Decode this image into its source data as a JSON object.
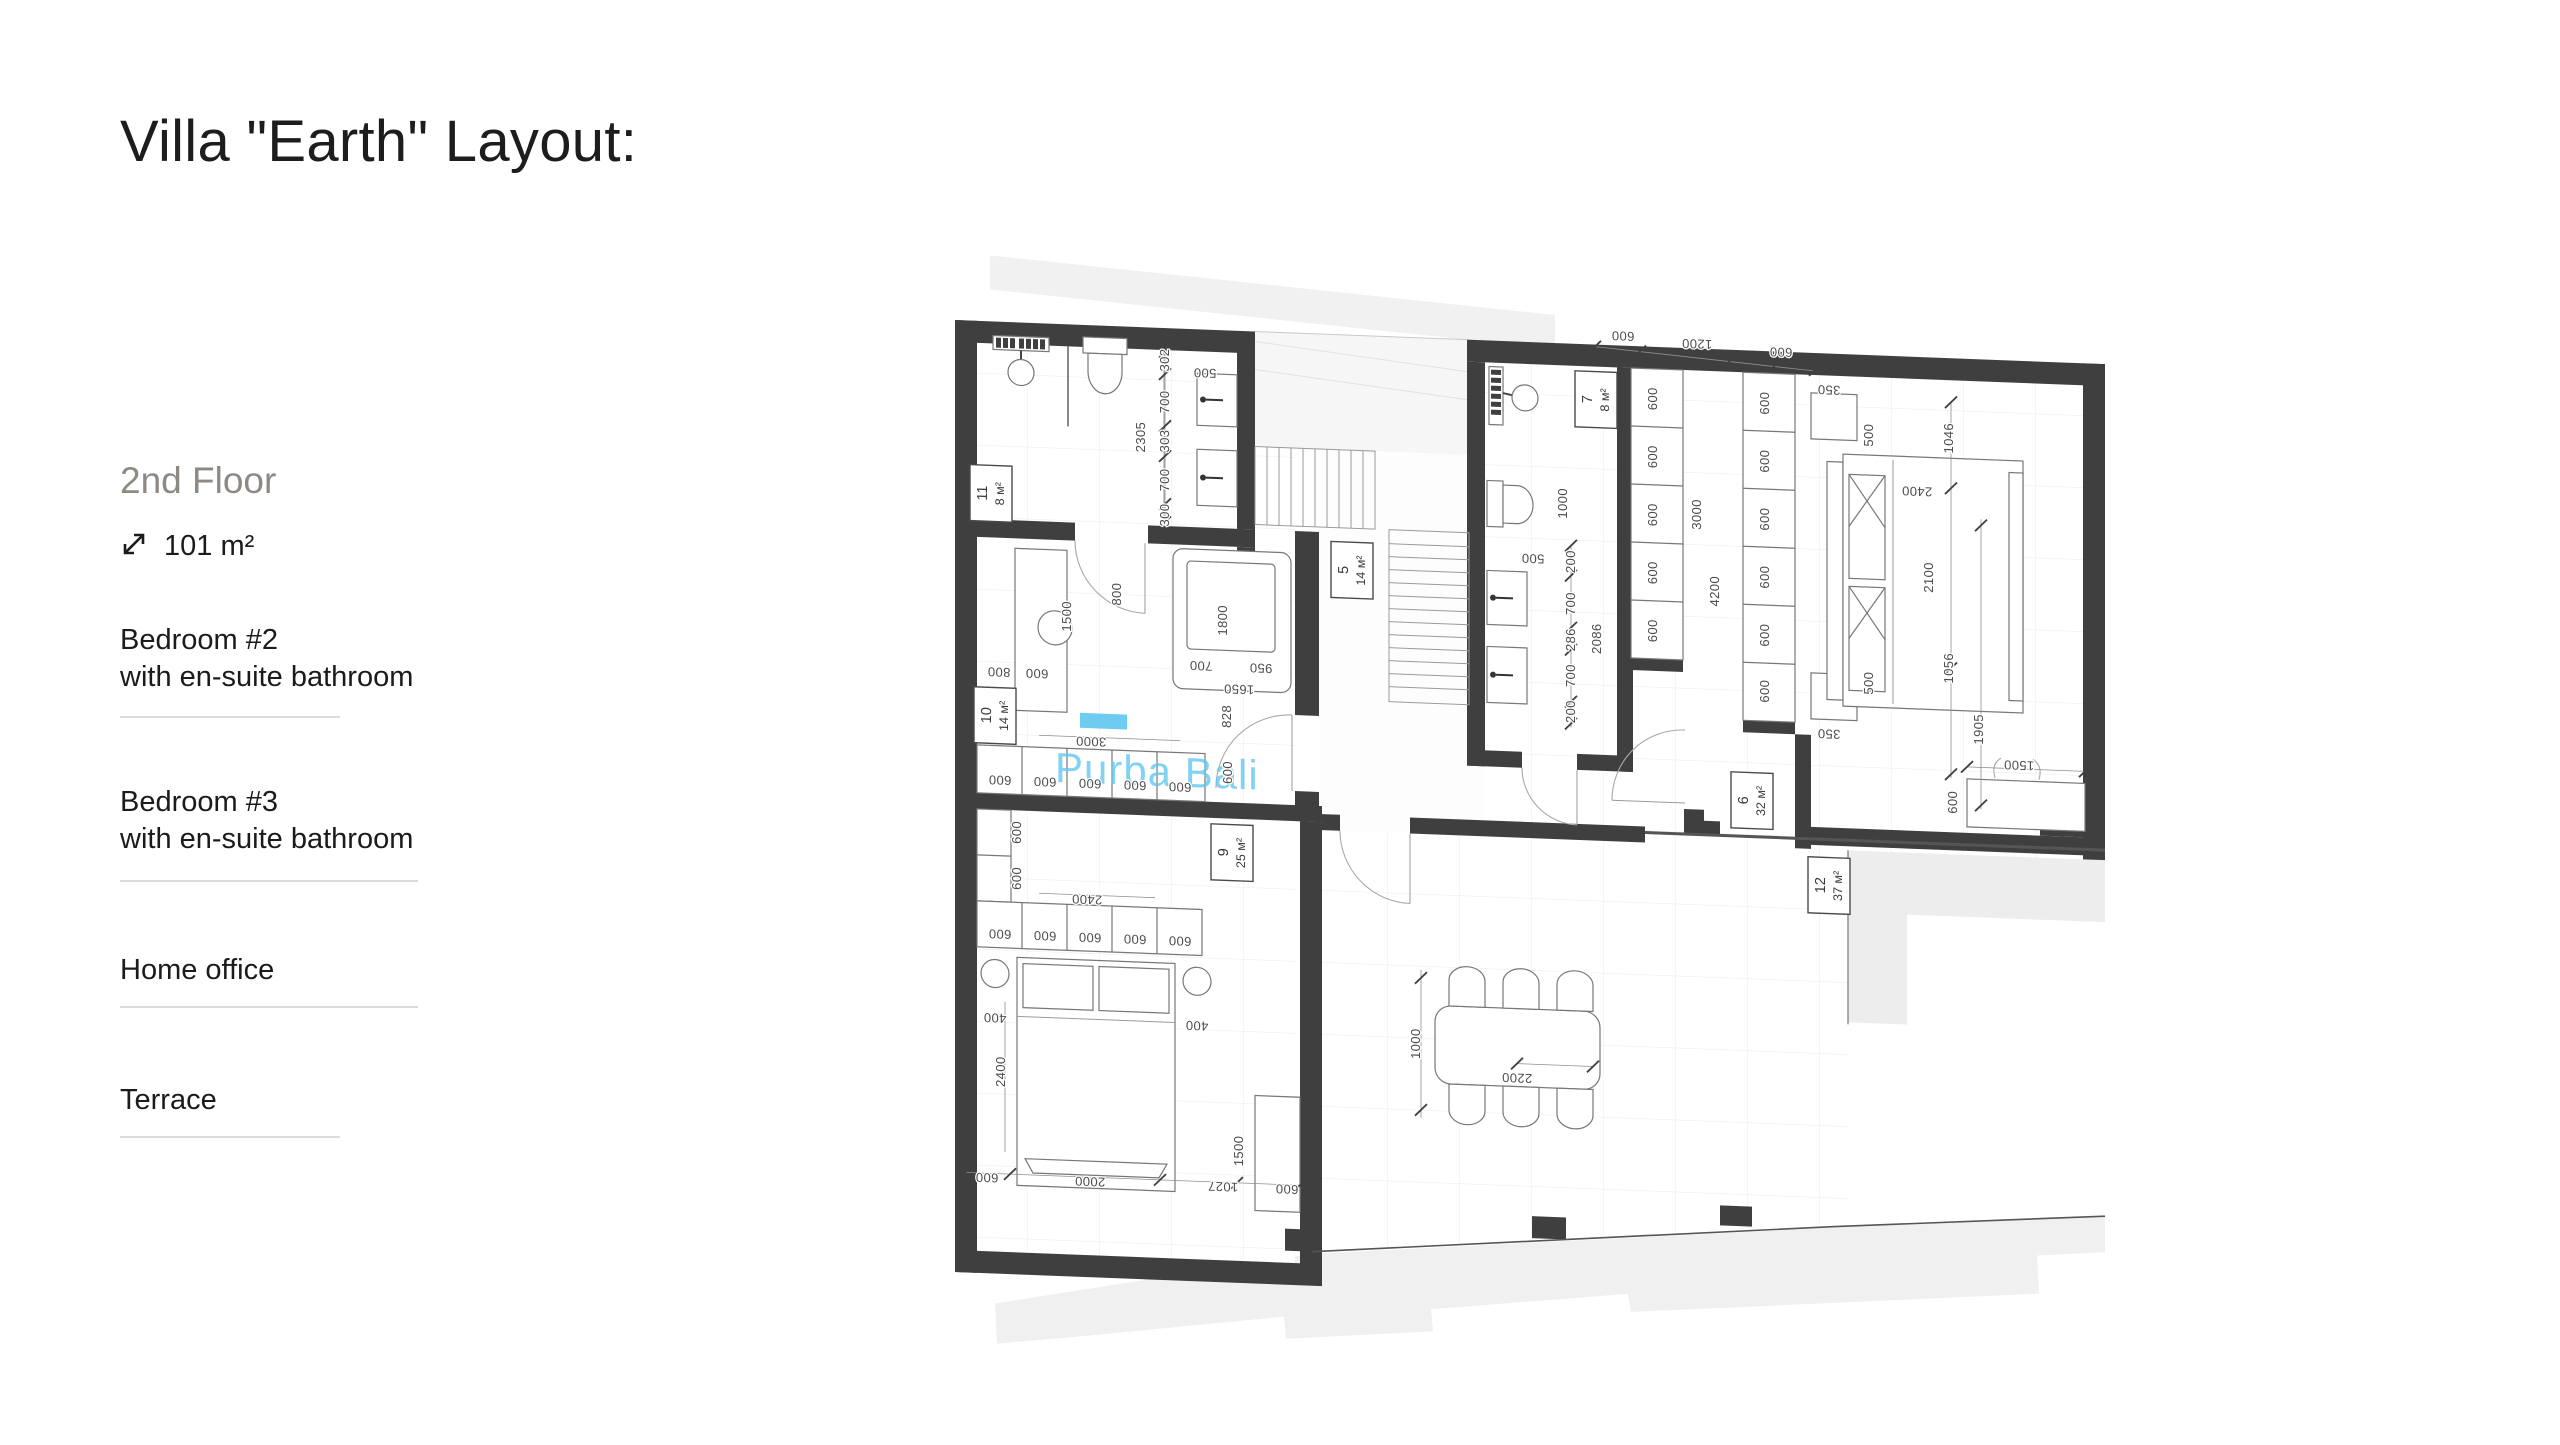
{
  "page": {
    "title": "Villa \"Earth\" Layout:"
  },
  "sidebar": {
    "floor_label": "2nd Floor",
    "area_value": "101 m²",
    "items": [
      {
        "label": "Bedroom #2",
        "sub": "with en-suite bathroom"
      },
      {
        "label": "Bedroom #3",
        "sub": "with en-suite bathroom"
      },
      {
        "label": "Home office",
        "sub": ""
      },
      {
        "label": "Terrace",
        "sub": ""
      }
    ]
  },
  "plan": {
    "watermark": "Purba Bali",
    "rooms": [
      {
        "num": "11",
        "area": "8 м²",
        "x": 36,
        "y": 192
      },
      {
        "num": "10",
        "area": "14 м²",
        "x": 40,
        "y": 414
      },
      {
        "num": "9",
        "area": "25 м²",
        "x": 277,
        "y": 542
      },
      {
        "num": "5",
        "area": "14 м²",
        "x": 397,
        "y": 255
      },
      {
        "num": "7",
        "area": "8 м²",
        "x": 641,
        "y": 75
      },
      {
        "num": "6",
        "area": "32 м²",
        "x": 797,
        "y": 470
      },
      {
        "num": "12",
        "area": "37 м²",
        "x": 874,
        "y": 552
      }
    ],
    "dims": [
      {
        "t": "600",
        "x": 668,
        "y": 6,
        "r": 180
      },
      {
        "t": "1200",
        "x": 742,
        "y": 11,
        "r": 180
      },
      {
        "t": "600",
        "x": 826,
        "y": 16,
        "r": 180
      },
      {
        "t": "500",
        "x": 250,
        "y": 59,
        "r": 180
      },
      {
        "t": "302",
        "x": 214,
        "y": 52,
        "r": -90
      },
      {
        "t": "700",
        "x": 214,
        "y": 94,
        "r": -90
      },
      {
        "t": "303",
        "x": 214,
        "y": 133,
        "r": -90
      },
      {
        "t": "700",
        "x": 214,
        "y": 172,
        "r": -90
      },
      {
        "t": "300",
        "x": 214,
        "y": 207,
        "r": -90
      },
      {
        "t": "2305",
        "x": 190,
        "y": 130,
        "r": -90
      },
      {
        "t": "1500",
        "x": 116,
        "y": 312,
        "r": -90
      },
      {
        "t": "800",
        "x": 166,
        "y": 288,
        "r": -90
      },
      {
        "t": "1800",
        "x": 272,
        "y": 310,
        "r": -90
      },
      {
        "t": "700",
        "x": 246,
        "y": 352,
        "r": 180
      },
      {
        "t": "950",
        "x": 306,
        "y": 352,
        "r": 180
      },
      {
        "t": "1650",
        "x": 284,
        "y": 374,
        "r": 180
      },
      {
        "t": "800",
        "x": 44,
        "y": 366,
        "r": 180
      },
      {
        "t": "600",
        "x": 82,
        "y": 366,
        "r": 180
      },
      {
        "t": "828",
        "x": 276,
        "y": 406,
        "r": -90
      },
      {
        "t": "600",
        "x": 277,
        "y": 462,
        "r": -90
      },
      {
        "t": "3000",
        "x": 136,
        "y": 432,
        "r": 180
      },
      {
        "t": "600",
        "x": 45,
        "y": 474,
        "r": 180
      },
      {
        "t": "600",
        "x": 90,
        "y": 474,
        "r": 180
      },
      {
        "t": "600",
        "x": 135,
        "y": 474,
        "r": 180
      },
      {
        "t": "600",
        "x": 180,
        "y": 474,
        "r": 180
      },
      {
        "t": "600",
        "x": 225,
        "y": 474,
        "r": 180
      },
      {
        "t": "600",
        "x": 66,
        "y": 530,
        "r": -90
      },
      {
        "t": "600",
        "x": 66,
        "y": 576,
        "r": -90
      },
      {
        "t": "2400",
        "x": 132,
        "y": 590,
        "r": 180
      },
      {
        "t": "600",
        "x": 45,
        "y": 628,
        "r": 180
      },
      {
        "t": "600",
        "x": 90,
        "y": 628,
        "r": 180
      },
      {
        "t": "600",
        "x": 135,
        "y": 628,
        "r": 180
      },
      {
        "t": "600",
        "x": 180,
        "y": 628,
        "r": 180
      },
      {
        "t": "600",
        "x": 225,
        "y": 628,
        "r": 180
      },
      {
        "t": "400",
        "x": 40,
        "y": 712,
        "r": 180
      },
      {
        "t": "400",
        "x": 242,
        "y": 712,
        "r": 180
      },
      {
        "t": "2400",
        "x": 50,
        "y": 770,
        "r": -90
      },
      {
        "t": "1500",
        "x": 288,
        "y": 840,
        "r": -90
      },
      {
        "t": "600",
        "x": 32,
        "y": 872,
        "r": 180
      },
      {
        "t": "2000",
        "x": 135,
        "y": 872,
        "r": 180
      },
      {
        "t": "1027",
        "x": 268,
        "y": 872,
        "r": 180
      },
      {
        "t": "600",
        "x": 332,
        "y": 872,
        "r": 180
      },
      {
        "t": "1000",
        "x": 612,
        "y": 180,
        "r": -90
      },
      {
        "t": "500",
        "x": 578,
        "y": 232,
        "r": 180
      },
      {
        "t": "200",
        "x": 620,
        "y": 238,
        "r": -90
      },
      {
        "t": "700",
        "x": 620,
        "y": 280,
        "r": -90
      },
      {
        "t": "286",
        "x": 620,
        "y": 316,
        "r": -90
      },
      {
        "t": "700",
        "x": 620,
        "y": 352,
        "r": -90
      },
      {
        "t": "200",
        "x": 620,
        "y": 388,
        "r": -90
      },
      {
        "t": "2086",
        "x": 646,
        "y": 314,
        "r": -90
      },
      {
        "t": "600",
        "x": 702,
        "y": 72,
        "r": -90
      },
      {
        "t": "600",
        "x": 702,
        "y": 130,
        "r": -90
      },
      {
        "t": "600",
        "x": 702,
        "y": 188,
        "r": -90
      },
      {
        "t": "600",
        "x": 702,
        "y": 246,
        "r": -90
      },
      {
        "t": "600",
        "x": 702,
        "y": 304,
        "r": -90
      },
      {
        "t": "3000",
        "x": 746,
        "y": 186,
        "r": -90
      },
      {
        "t": "600",
        "x": 814,
        "y": 72,
        "r": -90
      },
      {
        "t": "600",
        "x": 814,
        "y": 130,
        "r": -90
      },
      {
        "t": "600",
        "x": 814,
        "y": 188,
        "r": -90
      },
      {
        "t": "600",
        "x": 814,
        "y": 246,
        "r": -90
      },
      {
        "t": "600",
        "x": 814,
        "y": 304,
        "r": -90
      },
      {
        "t": "600",
        "x": 814,
        "y": 360,
        "r": -90
      },
      {
        "t": "4200",
        "x": 764,
        "y": 262,
        "r": -90
      },
      {
        "t": "350",
        "x": 874,
        "y": 52,
        "r": 180
      },
      {
        "t": "500",
        "x": 918,
        "y": 100,
        "r": -90
      },
      {
        "t": "350",
        "x": 874,
        "y": 396,
        "r": 180
      },
      {
        "t": "500",
        "x": 918,
        "y": 348,
        "r": -90
      },
      {
        "t": "2400",
        "x": 962,
        "y": 150,
        "r": 180
      },
      {
        "t": "2100",
        "x": 978,
        "y": 240,
        "r": -90
      },
      {
        "t": "1046",
        "x": 998,
        "y": 100,
        "r": -90
      },
      {
        "t": "1056",
        "x": 998,
        "y": 330,
        "r": -90
      },
      {
        "t": "1905",
        "x": 1028,
        "y": 390,
        "r": -90
      },
      {
        "t": "1500",
        "x": 1064,
        "y": 420,
        "r": 180
      },
      {
        "t": "600",
        "x": 1002,
        "y": 464,
        "r": -90
      },
      {
        "t": "2200",
        "x": 562,
        "y": 752,
        "r": 180
      },
      {
        "t": "1000",
        "x": 465,
        "y": 726,
        "r": -90
      }
    ]
  }
}
